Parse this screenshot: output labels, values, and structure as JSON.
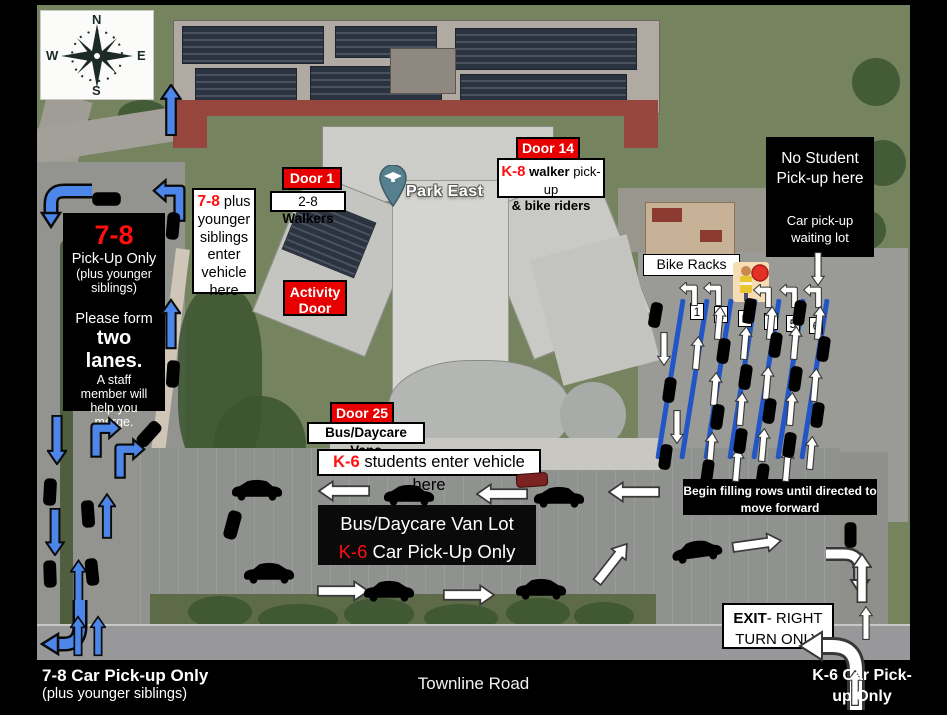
{
  "colors": {
    "red": "#e80000",
    "text_red": "#ff0f0f",
    "arrow_blue": "#4c86e9",
    "lane_blue": "#2256c7"
  },
  "compass": {
    "n": "N",
    "e": "E",
    "s": "S",
    "w": "W"
  },
  "map_pin": {
    "label": "Park East"
  },
  "left_panel": {
    "grade": "7-8",
    "line1": "Pick-Up Only",
    "line2": "(plus younger siblings)",
    "line3": "Please form",
    "line4": "two lanes.",
    "line5": "A staff member will help you merge."
  },
  "enter_78": {
    "grade": "7-8",
    "text": " plus younger siblings enter vehicle here"
  },
  "door_1": {
    "label": "Door 1"
  },
  "walkers_28": {
    "range": "2-8 ",
    "bold": "Walkers"
  },
  "activity_door": {
    "label": "Activity Door"
  },
  "door_14": {
    "label": "Door 14"
  },
  "k8_box": {
    "grade": "K-8",
    "bold1": " walker",
    "text1": " pick-up",
    "line2": "& bike riders"
  },
  "no_student": {
    "title": "No Student Pick-up here",
    "sub": "Car pick-up waiting lot"
  },
  "bike_racks": {
    "label": "Bike Racks"
  },
  "lane_numbers": [
    "1",
    "2",
    "3",
    "4",
    "5",
    "6"
  ],
  "begin_filling": {
    "text": "Begin filling rows until directed to move forward"
  },
  "door_25": {
    "label": "Door 25"
  },
  "bus_vans": {
    "label": "Bus/Daycare Vans"
  },
  "k6_enter": {
    "grade": "K-6",
    "text": " students enter vehicle here"
  },
  "van_lot": {
    "line1": "Bus/Daycare Van Lot",
    "grade": "K-6",
    "text": " Car Pick-Up Only"
  },
  "exit_box": {
    "bold": "EXIT",
    "text": "- RIGHT TURN ONLY"
  },
  "footer": {
    "left_title": "7-8 Car Pick-up Only",
    "left_sub": "(plus younger siblings)",
    "road": "Townline Road",
    "right_title": "K-6 Car Pick-up Only"
  }
}
